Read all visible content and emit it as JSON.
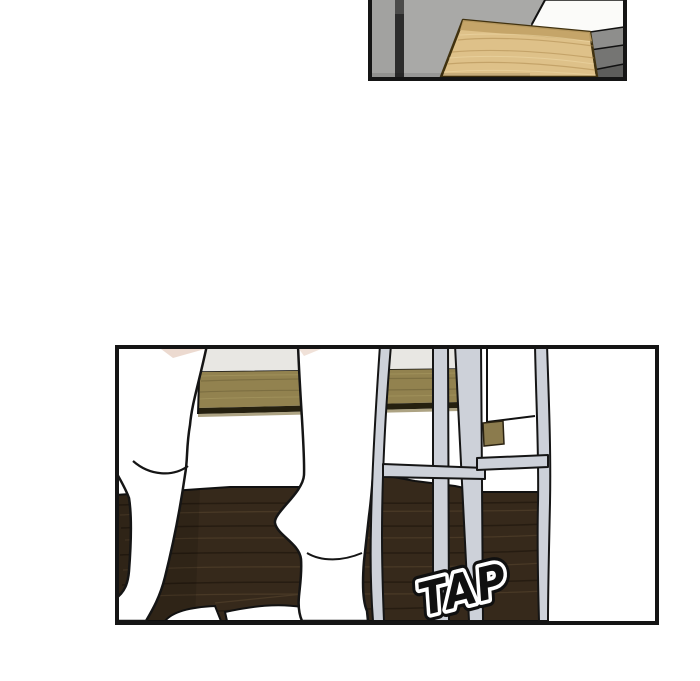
{
  "page": {
    "background": "#ffffff",
    "kind": "comic-page"
  },
  "panels": {
    "top": {
      "label": "room-corner-panel"
    },
    "bottom": {
      "label": "footstep-panel"
    }
  },
  "sfx": {
    "text": "TAP",
    "fill": "#101010",
    "outline": "#ffffff"
  },
  "colors": {
    "panel_border": "#151515",
    "cabinet_gray": "#a9a9a7",
    "cabinet_gray_left": "#a2a2a0",
    "cabinet_gap": "#2c2c2c",
    "backdrop_white": "#fbfbf9",
    "side_gray_1": "#8e8e8c",
    "side_gray_2": "#757573",
    "side_gray_3": "#5d5d5b",
    "board_wood": "#dec189",
    "board_wood_edge": "#c2a266",
    "bench_top_gray": "#e8e7e3",
    "bench_wood": "#92824f",
    "bench_shadow": "#25200f",
    "wall_white": "#ffffff",
    "floor_brown": "#36291b",
    "floor_streak_light": "#5c4a31",
    "floor_streak_dark": "#1c140c",
    "stool_gray": "#cdd1d9",
    "leg_white": "#ffffff",
    "skin": "#e9d4c8",
    "far_bench_wood": "#8b7b4d"
  }
}
